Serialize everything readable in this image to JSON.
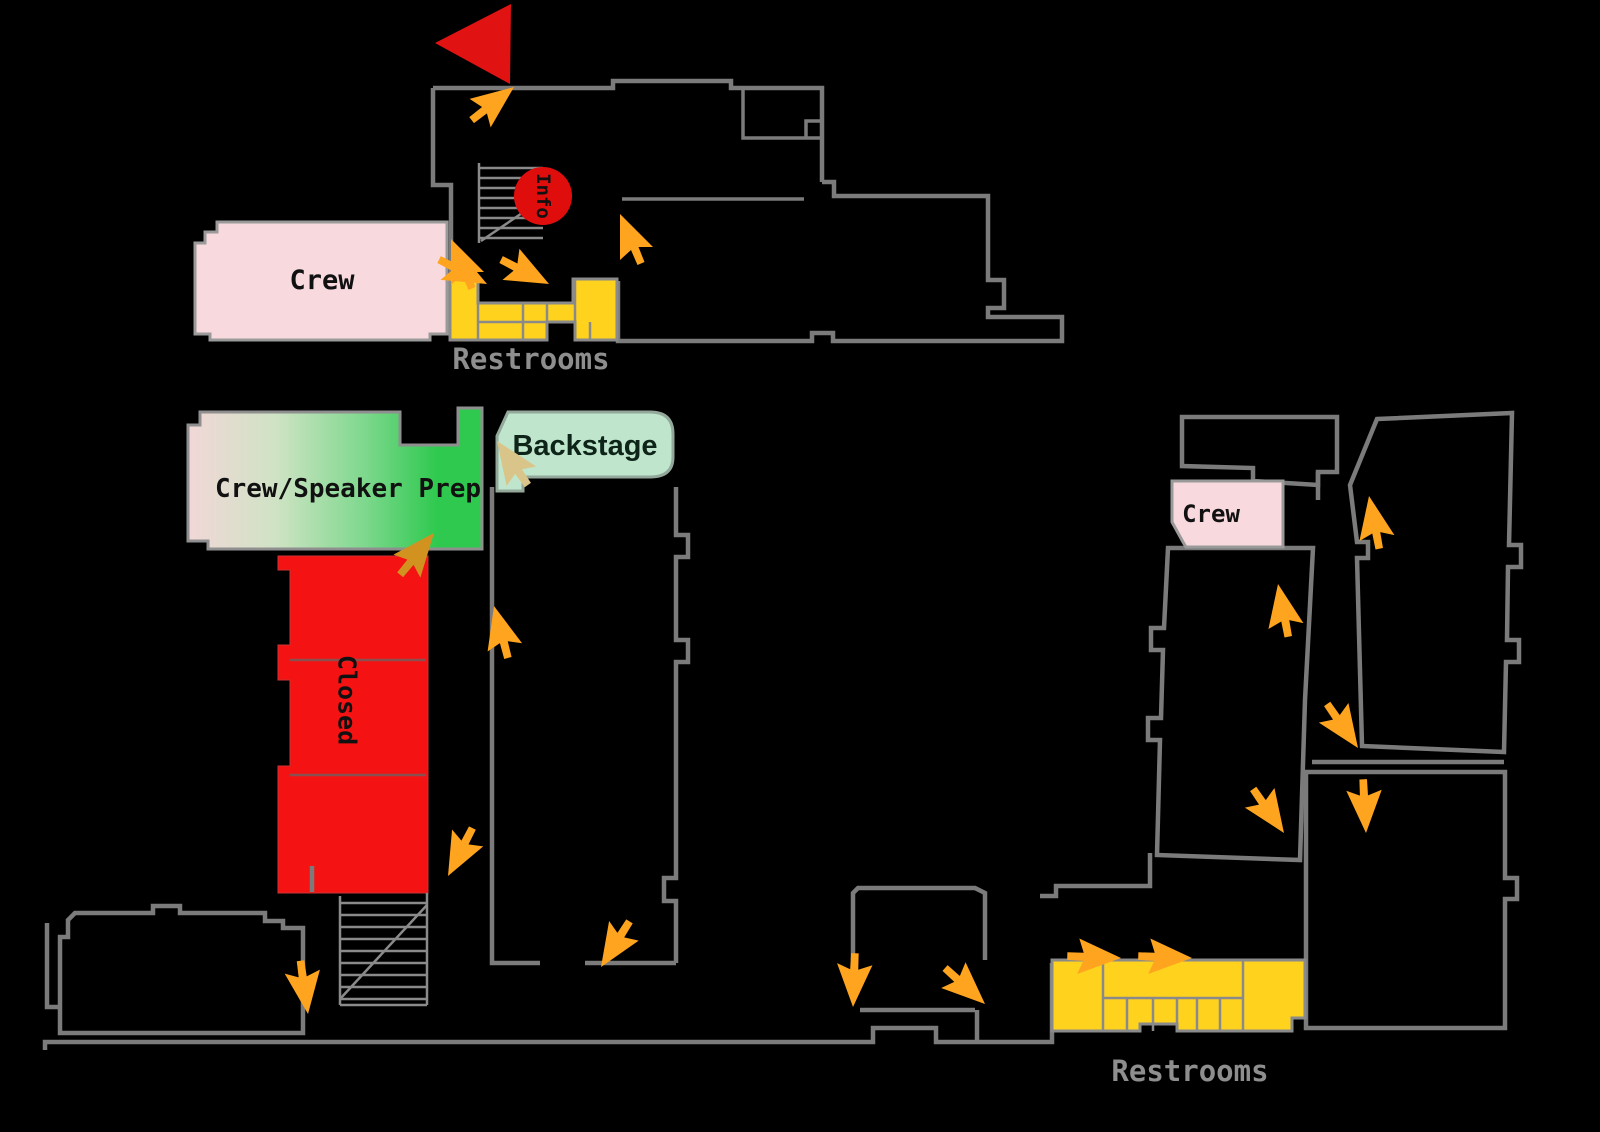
{
  "map": {
    "type": "venue-floor-plan",
    "labels": {
      "crew_top": "Crew",
      "restrooms_top": "Restrooms",
      "prep": "Crew/Speaker Prep",
      "backstage": "Backstage",
      "closed": "Closed",
      "info": "Info",
      "crew_right": "Crew",
      "restrooms_right": "Restrooms"
    },
    "colors": {
      "wall": "#7b7b7b",
      "room_border": "#9a9a9a",
      "crew": "#f8d9de",
      "restroom": "#ffd21e",
      "backstage": "#bfe6cd",
      "prep_start": "#f2d7d8",
      "prep_end": "#2ec94e",
      "closed": "#f51212",
      "flag": "#e01212",
      "info_badge": "#e00d0d",
      "arrow": "#ffa41e",
      "arrow_tan": "#d9c58a",
      "arrow_mustard": "#d29220",
      "label_gray": "#8e8e8e",
      "text_dark": "#111111"
    },
    "icons": {
      "flag": "flag-icon",
      "stairs": "stairs-icon",
      "arrow": "direction-arrow-icon",
      "info": "info-badge-icon"
    }
  }
}
